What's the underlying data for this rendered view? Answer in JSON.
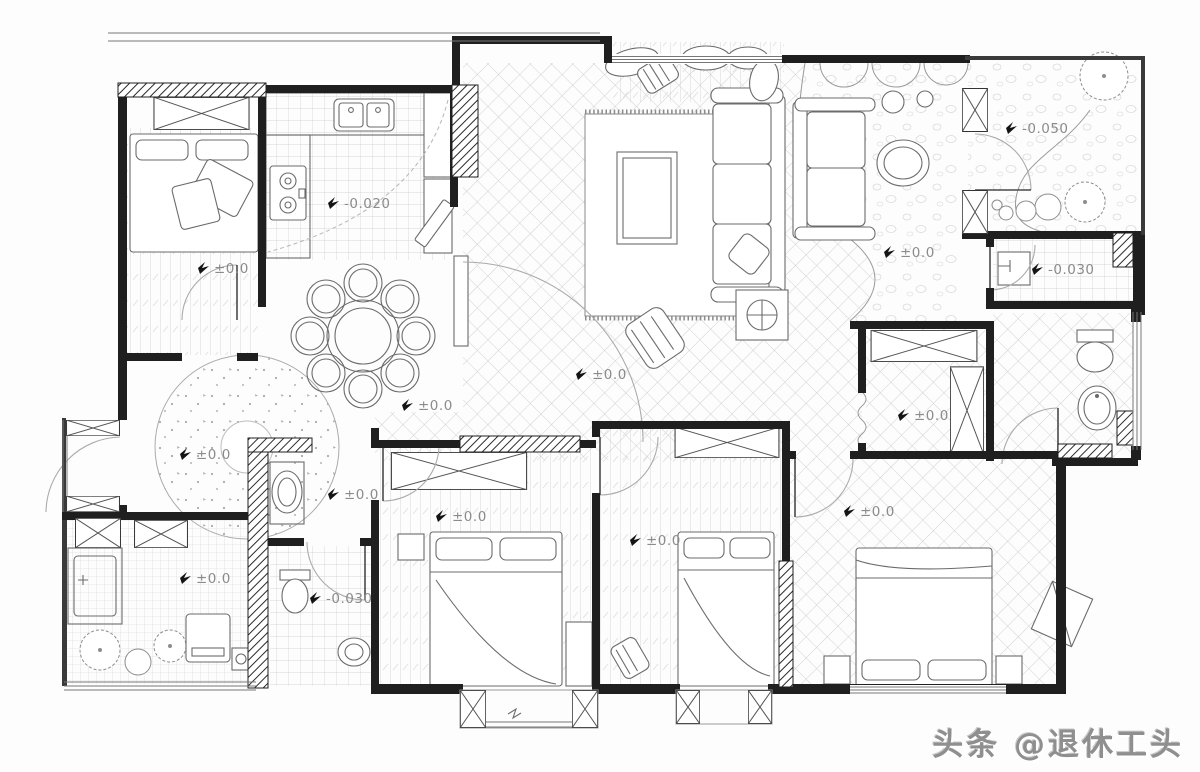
{
  "title": "residential floor plan",
  "watermark": {
    "text": "头条 @退休工头"
  },
  "colors": {
    "wall": "#1f1f1f",
    "annotation": "#8b8b8b",
    "watermark": "#8f8f8f"
  },
  "plan": {
    "elevation_labels": [
      {
        "room": "bedroom-top-left",
        "text": "±0.0"
      },
      {
        "room": "kitchen",
        "text": "-0.020"
      },
      {
        "room": "dining",
        "text": "±0.0"
      },
      {
        "room": "living-room",
        "text": "±0.0"
      },
      {
        "room": "sitting-top-right",
        "text": "±0.0"
      },
      {
        "room": "balcony-top-right",
        "text": "-0.050"
      },
      {
        "room": "laundry-right",
        "text": "-0.030"
      },
      {
        "room": "walk-in-closet",
        "text": "±0.0"
      },
      {
        "room": "foyer-circle",
        "text": "±0.0"
      },
      {
        "room": "foyer-lower",
        "text": "±0.0"
      },
      {
        "room": "bedroom-1",
        "text": "±0.0"
      },
      {
        "room": "bedroom-2",
        "text": "±0.0"
      },
      {
        "room": "master-bedroom",
        "text": "±0.0"
      },
      {
        "room": "balcony-bottom-left",
        "text": "±0.0"
      },
      {
        "room": "bathroom-bottom",
        "text": "-0.030"
      }
    ]
  }
}
